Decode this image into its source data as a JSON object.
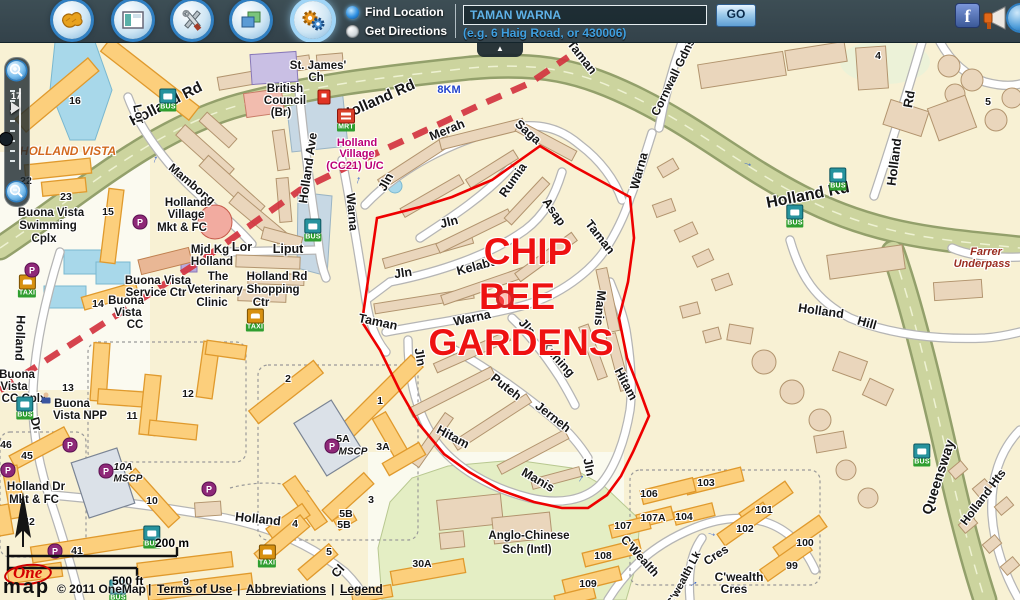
{
  "header": {
    "buttons": [
      {
        "name": "basemap-button",
        "icon": "map-icon"
      },
      {
        "name": "overview-button",
        "icon": "window-icon"
      },
      {
        "name": "tools-button",
        "icon": "tools-icon"
      },
      {
        "name": "layers-button",
        "icon": "layers-icon"
      },
      {
        "name": "settings-button",
        "icon": "gears-icon",
        "active": true
      }
    ],
    "radios": [
      {
        "label": "Find Location",
        "selected": true
      },
      {
        "label": "Get Directions",
        "selected": false
      }
    ],
    "search": {
      "value": "TAMAN WARNA",
      "go": "GO",
      "hint": "(e.g. 6 Haig Road, or 430006)"
    },
    "social": [
      "facebook-icon",
      "megaphone-icon"
    ]
  },
  "zoom_control": {
    "level": "17"
  },
  "map": {
    "region_title": {
      "color": "#ee1111",
      "size": 37,
      "lines": [
        {
          "t": "CHIP",
          "x": 528,
          "y": 252
        },
        {
          "t": "BEE",
          "x": 517,
          "y": 297
        },
        {
          "t": "GARDENS",
          "x": 521,
          "y": 343
        }
      ]
    },
    "labels": [
      {
        "t": "Holland Rd",
        "x": 166,
        "y": 104,
        "r": -27,
        "s": 15
      },
      {
        "t": "Holland Rd",
        "x": 378,
        "y": 100,
        "r": -24,
        "s": 15
      },
      {
        "t": "Holland Rd",
        "x": 808,
        "y": 196,
        "r": -11,
        "s": 16
      },
      {
        "t": "Holland",
        "x": 894,
        "y": 162,
        "r": -83,
        "s": 13
      },
      {
        "t": "Rd",
        "x": 909,
        "y": 99,
        "r": -80,
        "s": 13
      },
      {
        "t": "Cornwall Gdns",
        "x": 673,
        "y": 77,
        "r": -64,
        "s": 12
      },
      {
        "t": "Lor",
        "x": 139,
        "y": 114,
        "r": 78,
        "s": 12
      },
      {
        "t": "Mambong",
        "x": 192,
        "y": 184,
        "r": 40,
        "s": 12
      },
      {
        "t": "Holland Ave",
        "x": 308,
        "y": 168,
        "r": -82,
        "s": 12.5
      },
      {
        "t": "Lor",
        "x": 242,
        "y": 247,
        "s": 12.5
      },
      {
        "t": "Liput",
        "x": 288,
        "y": 249,
        "s": 12.5
      },
      {
        "t": "Warna",
        "x": 352,
        "y": 212,
        "r": 85,
        "s": 12.5
      },
      {
        "t": "Taman",
        "x": 378,
        "y": 322,
        "r": 12,
        "s": 12.5
      },
      {
        "t": "Jln",
        "x": 386,
        "y": 182,
        "r": -62,
        "s": 12.5
      },
      {
        "t": "Merah",
        "x": 447,
        "y": 130,
        "r": -22,
        "s": 12.5
      },
      {
        "t": "Saga",
        "x": 528,
        "y": 132,
        "r": 42,
        "s": 12.5
      },
      {
        "t": "Jln",
        "x": 449,
        "y": 222,
        "r": -14,
        "s": 12.5
      },
      {
        "t": "Rumia",
        "x": 513,
        "y": 180,
        "r": -55,
        "s": 12.5
      },
      {
        "t": "Jln",
        "x": 403,
        "y": 273,
        "r": -8,
        "s": 12.5
      },
      {
        "t": "Kelabu",
        "x": 477,
        "y": 266,
        "r": -15,
        "s": 12.5
      },
      {
        "t": "Asap",
        "x": 554,
        "y": 212,
        "r": 55,
        "s": 12.5
      },
      {
        "t": "Warna",
        "x": 472,
        "y": 318,
        "r": -12,
        "s": 12.5
      },
      {
        "t": "Jln",
        "x": 527,
        "y": 327,
        "r": 48,
        "s": 12.5
      },
      {
        "t": "Kuning",
        "x": 558,
        "y": 359,
        "r": 48,
        "s": 12.5
      },
      {
        "t": "Puteh",
        "x": 506,
        "y": 387,
        "r": 38,
        "s": 12.5
      },
      {
        "t": "Jerneh",
        "x": 553,
        "y": 417,
        "r": 38,
        "s": 12.5
      },
      {
        "t": "Jln",
        "x": 420,
        "y": 357,
        "r": 80,
        "s": 12.5
      },
      {
        "t": "Hitam",
        "x": 453,
        "y": 437,
        "r": 28,
        "s": 12.5
      },
      {
        "t": "Manis",
        "x": 538,
        "y": 480,
        "r": 30,
        "s": 12.5
      },
      {
        "t": "Jln",
        "x": 589,
        "y": 467,
        "r": 78,
        "s": 12.5
      },
      {
        "t": "Hitam",
        "x": 626,
        "y": 384,
        "r": 62,
        "s": 12.5
      },
      {
        "t": "Manis",
        "x": 600,
        "y": 308,
        "r": 95,
        "s": 12.5
      },
      {
        "t": "Taman",
        "x": 600,
        "y": 237,
        "r": 52,
        "s": 12.5
      },
      {
        "t": "Warna",
        "x": 639,
        "y": 171,
        "r": -75,
        "s": 12.5
      },
      {
        "t": "Taman",
        "x": 582,
        "y": 57,
        "r": 52,
        "s": 12.5
      },
      {
        "t": "Queensway",
        "x": 938,
        "y": 477,
        "r": -72,
        "s": 14
      },
      {
        "t": "Holland Hts",
        "x": 983,
        "y": 497,
        "r": -53,
        "s": 12
      },
      {
        "t": "Holland",
        "x": 821,
        "y": 311,
        "r": 8,
        "s": 12.5
      },
      {
        "t": "Hill",
        "x": 867,
        "y": 323,
        "r": 16,
        "s": 12.5
      },
      {
        "t": "Holland",
        "x": 20,
        "y": 338,
        "r": 92,
        "s": 12.5
      },
      {
        "t": "Dr",
        "x": 36,
        "y": 424,
        "r": 75,
        "s": 12.5
      },
      {
        "t": "Holland",
        "x": 258,
        "y": 519,
        "r": 6,
        "s": 12.5
      },
      {
        "t": "Cl",
        "x": 338,
        "y": 571,
        "r": -48,
        "s": 12.5
      },
      {
        "t": "C'Wealth",
        "x": 640,
        "y": 556,
        "r": 48,
        "s": 12
      },
      {
        "t": "Cres",
        "x": 716,
        "y": 555,
        "r": -33,
        "s": 12
      },
      {
        "t": "C'wealth Lk",
        "x": 684,
        "y": 579,
        "r": -62,
        "s": 11
      },
      {
        "t": "C'wealth",
        "x": 739,
        "y": 577,
        "s": 12
      },
      {
        "t": "Cres",
        "x": 734,
        "y": 589,
        "s": 12
      },
      {
        "t": "HOLLAND VISTA",
        "x": 68,
        "y": 151,
        "s": 12,
        "c": "#d2691e",
        "i": 1
      },
      {
        "t": "Farrer",
        "x": 986,
        "y": 252,
        "s": 11,
        "c": "#9a2c20",
        "i": 1
      },
      {
        "t": "Underpass",
        "x": 982,
        "y": 264,
        "s": 11,
        "c": "#9a2c20",
        "i": 1
      },
      {
        "t": "8KM",
        "x": 449,
        "y": 90,
        "s": 11,
        "c": "#2244cc"
      },
      {
        "t": "Holland",
        "x": 357,
        "y": 143,
        "s": 11,
        "c": "#bb0077"
      },
      {
        "t": "Village",
        "x": 357,
        "y": 154,
        "s": 11,
        "c": "#bb0077"
      },
      {
        "t": "(CC21) U/C",
        "x": 355,
        "y": 166,
        "s": 11,
        "c": "#bb0077"
      },
      {
        "t": "St. James'",
        "x": 318,
        "y": 66,
        "s": 11.5
      },
      {
        "t": "Ch",
        "x": 316,
        "y": 78,
        "s": 11.5
      },
      {
        "t": "British",
        "x": 285,
        "y": 89,
        "s": 11.5
      },
      {
        "t": "Council",
        "x": 285,
        "y": 101,
        "s": 11.5
      },
      {
        "t": "(Br)",
        "x": 281,
        "y": 113,
        "s": 11.5
      },
      {
        "t": "Buona Vista",
        "x": 51,
        "y": 213,
        "s": 11.5
      },
      {
        "t": "Swimming",
        "x": 48,
        "y": 226,
        "s": 11.5
      },
      {
        "t": "Cplx",
        "x": 44,
        "y": 239,
        "s": 11.5
      },
      {
        "t": "Holland",
        "x": 186,
        "y": 203,
        "s": 11.5
      },
      {
        "t": "Village",
        "x": 186,
        "y": 215,
        "s": 11.5
      },
      {
        "t": "Mkt & FC",
        "x": 182,
        "y": 228,
        "s": 11.5
      },
      {
        "t": "Mjd Kg",
        "x": 210,
        "y": 250,
        "s": 11.5
      },
      {
        "t": "Holland",
        "x": 212,
        "y": 262,
        "s": 11.5
      },
      {
        "t": "The",
        "x": 218,
        "y": 277,
        "s": 11.5
      },
      {
        "t": "Veterinary",
        "x": 215,
        "y": 290,
        "s": 11.5
      },
      {
        "t": "Clinic",
        "x": 212,
        "y": 303,
        "s": 11.5
      },
      {
        "t": "Holland Rd",
        "x": 277,
        "y": 277,
        "s": 11.5
      },
      {
        "t": "Shopping",
        "x": 273,
        "y": 290,
        "s": 11.5
      },
      {
        "t": "Ctr",
        "x": 261,
        "y": 303,
        "s": 11.5
      },
      {
        "t": "Buona Vista",
        "x": 158,
        "y": 281,
        "s": 11.5
      },
      {
        "t": "Service Ctr",
        "x": 156,
        "y": 293,
        "s": 11.5
      },
      {
        "t": "Buona",
        "x": 126,
        "y": 301,
        "s": 11.5
      },
      {
        "t": "Vista",
        "x": 128,
        "y": 313,
        "s": 11.5
      },
      {
        "t": "CC",
        "x": 135,
        "y": 325,
        "s": 11.5
      },
      {
        "t": "Buona",
        "x": 17,
        "y": 375,
        "s": 11.5
      },
      {
        "t": "Vista",
        "x": 14,
        "y": 387,
        "s": 11.5
      },
      {
        "t": "CC Cplx",
        "x": 24,
        "y": 399,
        "s": 11.5
      },
      {
        "t": "Buona",
        "x": 72,
        "y": 404,
        "s": 11.5
      },
      {
        "t": "Vista NPP",
        "x": 80,
        "y": 416,
        "s": 11.5
      },
      {
        "t": "Holland Dr",
        "x": 36,
        "y": 487,
        "s": 11.5
      },
      {
        "t": "Mkt & FC",
        "x": 34,
        "y": 500,
        "s": 11.5
      },
      {
        "t": "Anglo-Chinese",
        "x": 529,
        "y": 536,
        "s": 11.5
      },
      {
        "t": "Sch (Intl)",
        "x": 527,
        "y": 550,
        "s": 11.5
      },
      {
        "t": "16",
        "x": 75,
        "y": 101,
        "s": 10.5
      },
      {
        "t": "22",
        "x": 26,
        "y": 181,
        "s": 10.5
      },
      {
        "t": "23",
        "x": 66,
        "y": 197,
        "s": 10.5
      },
      {
        "t": "15",
        "x": 108,
        "y": 212,
        "s": 10.5
      },
      {
        "t": "14",
        "x": 98,
        "y": 304,
        "s": 10.5
      },
      {
        "t": "13",
        "x": 68,
        "y": 388,
        "s": 10.5
      },
      {
        "t": "12",
        "x": 188,
        "y": 394,
        "s": 10.5
      },
      {
        "t": "11",
        "x": 132,
        "y": 416,
        "s": 10.5
      },
      {
        "t": "2",
        "x": 288,
        "y": 379,
        "s": 10.5
      },
      {
        "t": "1",
        "x": 380,
        "y": 401,
        "s": 10.5
      },
      {
        "t": "3A",
        "x": 383,
        "y": 447,
        "s": 10.5
      },
      {
        "t": "3",
        "x": 371,
        "y": 500,
        "s": 10.5
      },
      {
        "t": "4",
        "x": 295,
        "y": 524,
        "s": 10.5
      },
      {
        "t": "5A",
        "x": 343,
        "y": 439,
        "s": 10.5
      },
      {
        "t": "MSCP",
        "x": 353,
        "y": 452,
        "s": 10,
        "i": 1
      },
      {
        "t": "5B",
        "x": 346,
        "y": 514,
        "s": 10.5
      },
      {
        "t": "5B",
        "x": 344,
        "y": 525,
        "s": 10.5
      },
      {
        "t": "45",
        "x": 27,
        "y": 456,
        "s": 10.5
      },
      {
        "t": "46",
        "x": 6,
        "y": 445,
        "s": 10.5
      },
      {
        "t": "10A",
        "x": 123,
        "y": 467,
        "s": 10.5,
        "i": 1
      },
      {
        "t": "MSCP",
        "x": 128,
        "y": 479,
        "s": 10,
        "i": 1
      },
      {
        "t": "10",
        "x": 152,
        "y": 501,
        "s": 10.5
      },
      {
        "t": "42",
        "x": 29,
        "y": 522,
        "s": 10.5
      },
      {
        "t": "41",
        "x": 77,
        "y": 551,
        "s": 10.5
      },
      {
        "t": "9",
        "x": 186,
        "y": 582,
        "s": 10.5
      },
      {
        "t": "5",
        "x": 329,
        "y": 552,
        "s": 10.5
      },
      {
        "t": "30A",
        "x": 422,
        "y": 564,
        "s": 10.5
      },
      {
        "t": "106",
        "x": 649,
        "y": 494,
        "s": 10.5
      },
      {
        "t": "103",
        "x": 706,
        "y": 483,
        "s": 10.5
      },
      {
        "t": "107A",
        "x": 653,
        "y": 518,
        "s": 10.5
      },
      {
        "t": "104",
        "x": 684,
        "y": 517,
        "s": 10.5
      },
      {
        "t": "107",
        "x": 623,
        "y": 526,
        "s": 10.5
      },
      {
        "t": "101",
        "x": 764,
        "y": 510,
        "s": 10.5
      },
      {
        "t": "102",
        "x": 745,
        "y": 529,
        "s": 10.5
      },
      {
        "t": "100",
        "x": 805,
        "y": 543,
        "s": 10.5
      },
      {
        "t": "99",
        "x": 792,
        "y": 566,
        "s": 10.5
      },
      {
        "t": "108",
        "x": 603,
        "y": 556,
        "s": 10.5
      },
      {
        "t": "109",
        "x": 588,
        "y": 584,
        "s": 10.5
      },
      {
        "t": "4",
        "x": 878,
        "y": 56,
        "s": 10.5
      },
      {
        "t": "5",
        "x": 988,
        "y": 102,
        "s": 10.5
      }
    ],
    "icons": [
      {
        "n": "mrt-icon",
        "label": "MRT",
        "x": 346,
        "y": 120
      },
      {
        "n": "bus-icon",
        "label": "BUS",
        "x": 168,
        "y": 100
      },
      {
        "n": "bus-icon",
        "label": "BUS",
        "x": 313,
        "y": 230
      },
      {
        "n": "bus-icon",
        "label": "BUS",
        "x": 838,
        "y": 179
      },
      {
        "n": "bus-icon",
        "label": "BUS",
        "x": 795,
        "y": 216
      },
      {
        "n": "bus-icon",
        "label": "BUS",
        "x": 922,
        "y": 455
      },
      {
        "n": "bus-icon",
        "label": "BUS",
        "x": 152,
        "y": 537
      },
      {
        "n": "bus-icon",
        "label": "BUS",
        "x": 25,
        "y": 408
      },
      {
        "n": "bus-icon",
        "label": "BUS",
        "x": 118,
        "y": 591
      },
      {
        "n": "taxi-icon",
        "label": "TAXI",
        "x": 255,
        "y": 320
      },
      {
        "n": "taxi-icon",
        "label": "TAXI",
        "x": 27,
        "y": 286
      },
      {
        "n": "taxi-icon",
        "label": "TAXI",
        "x": 267,
        "y": 556
      },
      {
        "n": "parking-icon",
        "label": "P",
        "x": 140,
        "y": 222
      },
      {
        "n": "parking-icon",
        "label": "P",
        "x": 32,
        "y": 270
      },
      {
        "n": "parking-icon",
        "label": "P",
        "x": 70,
        "y": 445
      },
      {
        "n": "parking-icon",
        "label": "P",
        "x": 8,
        "y": 470
      },
      {
        "n": "parking-icon",
        "label": "P",
        "x": 106,
        "y": 471
      },
      {
        "n": "parking-icon",
        "label": "P",
        "x": 332,
        "y": 446
      },
      {
        "n": "parking-icon",
        "label": "P",
        "x": 55,
        "y": 551
      },
      {
        "n": "parking-icon",
        "label": "P",
        "x": 209,
        "y": 489
      },
      {
        "n": "petrol-icon",
        "x": 324,
        "y": 97
      },
      {
        "n": "police-icon",
        "x": 46,
        "y": 398
      },
      {
        "n": "location-marker",
        "x": 505,
        "y": 299
      },
      {
        "n": "oneway-arrow",
        "x": 748,
        "y": 163,
        "r": 18
      },
      {
        "n": "oneway-arrow",
        "x": 154,
        "y": 159,
        "r": -70
      },
      {
        "n": "oneway-arrow",
        "x": 357,
        "y": 180,
        "r": -75
      },
      {
        "n": "oneway-arrow",
        "x": 712,
        "y": 533,
        "r": 15
      },
      {
        "n": "oneway-arrow",
        "x": 580,
        "y": 478,
        "r": -60
      },
      {
        "n": "oneway-arrow",
        "x": 693,
        "y": 583,
        "r": -35
      }
    ],
    "scale": {
      "metric": "200 m",
      "imperial": "500 ft"
    }
  },
  "footer": {
    "logo": {
      "part1": "One",
      "part2": "map"
    },
    "copyright": "© 2011 OneMap",
    "links": [
      "Terms of Use",
      "Abbreviations",
      "Legend"
    ],
    "separator": "|"
  }
}
